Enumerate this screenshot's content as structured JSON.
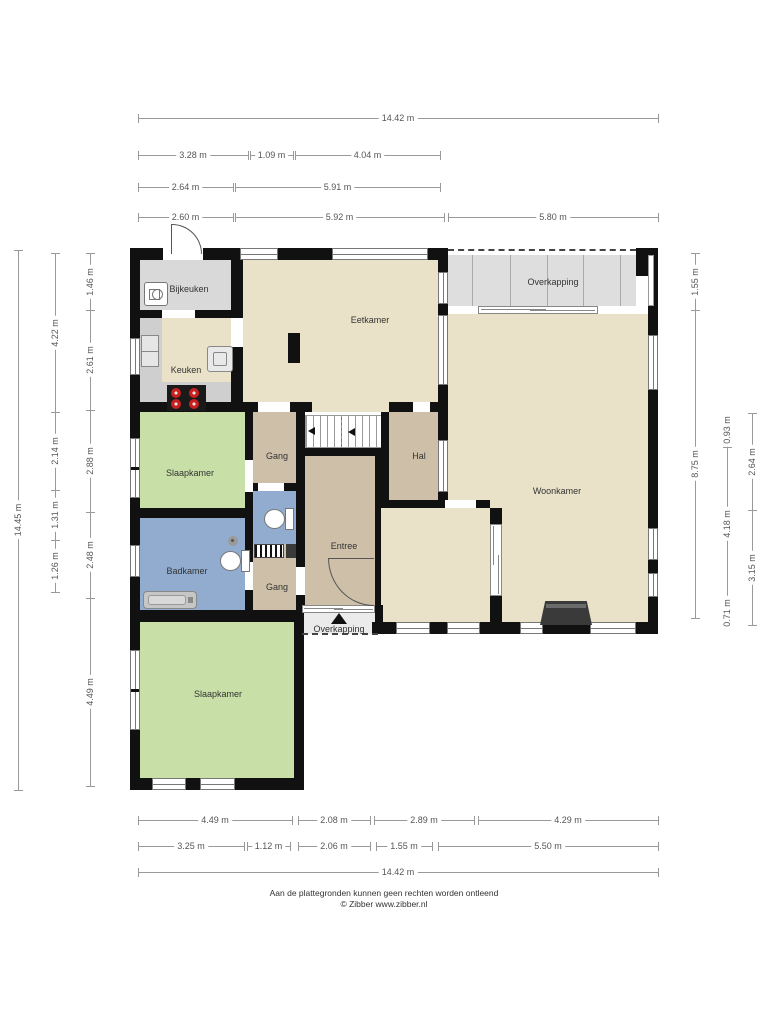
{
  "footer": {
    "line1": "Aan de plattegronden kunnen geen rechten worden ontleend",
    "line2": "© Zibber www.zibber.nl"
  },
  "colors": {
    "cream": "#e9e2c8",
    "tan": "#cdbfa8",
    "green": "#c8e0a8",
    "blue": "#91acce",
    "grayroom": "#d9d9d9",
    "overkap": "#dedede",
    "overkap2": "#ebebeb",
    "wall": "#111111",
    "stove_burner": "#c72020"
  },
  "rooms": [
    {
      "name": "bijkeuken",
      "label": "Bijkeuken",
      "x": 140,
      "y": 260,
      "w": 91,
      "h": 50,
      "fill": "grayroom",
      "lx": 189,
      "ly": 289
    },
    {
      "name": "keuken",
      "label": "Keuken",
      "x": 140,
      "y": 318,
      "w": 103,
      "h": 94,
      "fill": "cream",
      "lx": 186,
      "ly": 370
    },
    {
      "name": "eetkamer",
      "label": "Eetkamer",
      "x": 243,
      "y": 260,
      "w": 195,
      "h": 152,
      "fill": "cream",
      "lx": 370,
      "ly": 320
    },
    {
      "name": "overkapping-boven",
      "label": "Overkapping",
      "x": 448,
      "y": 255,
      "w": 188,
      "h": 51,
      "fill": "overkap",
      "lx": 553,
      "ly": 282
    },
    {
      "name": "woonkamer",
      "label": "Woonkamer",
      "x": 448,
      "y": 314,
      "w": 200,
      "h": 310,
      "fill": "cream",
      "lx": 557,
      "ly": 491
    },
    {
      "name": "woonkamer-nis",
      "label": "",
      "x": 381,
      "y": 508,
      "w": 109,
      "h": 116,
      "fill": "cream",
      "lx": 0,
      "ly": 0
    },
    {
      "name": "hal",
      "label": "Hal",
      "x": 381,
      "y": 412,
      "w": 57,
      "h": 88,
      "fill": "tan",
      "lx": 419,
      "ly": 456
    },
    {
      "name": "gang-boven",
      "label": "Gang",
      "x": 253,
      "y": 412,
      "w": 43,
      "h": 71,
      "fill": "tan",
      "lx": 277,
      "ly": 456
    },
    {
      "name": "entree",
      "label": "Entree",
      "x": 305,
      "y": 456,
      "w": 70,
      "h": 151,
      "fill": "tan",
      "lx": 344,
      "ly": 546
    },
    {
      "name": "toilet",
      "label": "",
      "x": 253,
      "y": 491,
      "w": 43,
      "h": 53,
      "fill": "blue",
      "lx": 0,
      "ly": 0
    },
    {
      "name": "gang-onder",
      "label": "Gang",
      "x": 253,
      "y": 544,
      "w": 43,
      "h": 66,
      "fill": "tan",
      "lx": 277,
      "ly": 587
    },
    {
      "name": "badkamer",
      "label": "Badkamer",
      "x": 140,
      "y": 518,
      "w": 105,
      "h": 92,
      "fill": "blue",
      "lx": 187,
      "ly": 571
    },
    {
      "name": "slaapkamer-1",
      "label": "Slaapkamer",
      "x": 140,
      "y": 412,
      "w": 105,
      "h": 96,
      "fill": "green",
      "lx": 190,
      "ly": 473
    },
    {
      "name": "slaapkamer-2",
      "label": "Slaapkamer",
      "x": 140,
      "y": 622,
      "w": 154,
      "h": 156,
      "fill": "green",
      "lx": 218,
      "ly": 694
    },
    {
      "name": "overkapping-onder",
      "label": "Overkapping",
      "x": 302,
      "y": 610,
      "w": 73,
      "h": 24,
      "fill": "overkap2",
      "lx": 339,
      "ly": 629
    }
  ],
  "walls": [
    {
      "x": 130,
      "y": 248,
      "w": 318,
      "h": 12
    },
    {
      "x": 636,
      "y": 248,
      "w": 22,
      "h": 28
    },
    {
      "x": 648,
      "y": 276,
      "w": 10,
      "h": 358
    },
    {
      "x": 372,
      "y": 622,
      "w": 286,
      "h": 12
    },
    {
      "x": 130,
      "y": 248,
      "w": 10,
      "h": 542
    },
    {
      "x": 130,
      "y": 778,
      "w": 174,
      "h": 12
    },
    {
      "x": 294,
      "y": 610,
      "w": 10,
      "h": 180
    },
    {
      "x": 130,
      "y": 610,
      "w": 174,
      "h": 12
    },
    {
      "x": 231,
      "y": 248,
      "w": 12,
      "h": 70
    },
    {
      "x": 140,
      "y": 310,
      "w": 91,
      "h": 8
    },
    {
      "x": 231,
      "y": 347,
      "w": 12,
      "h": 65
    },
    {
      "x": 438,
      "y": 255,
      "w": 10,
      "h": 157
    },
    {
      "x": 130,
      "y": 402,
      "w": 123,
      "h": 10
    },
    {
      "x": 243,
      "y": 402,
      "w": 15,
      "h": 10
    },
    {
      "x": 290,
      "y": 402,
      "w": 22,
      "h": 10
    },
    {
      "x": 389,
      "y": 402,
      "w": 59,
      "h": 10
    },
    {
      "x": 245,
      "y": 412,
      "w": 8,
      "h": 98
    },
    {
      "x": 130,
      "y": 508,
      "w": 123,
      "h": 10
    },
    {
      "x": 245,
      "y": 518,
      "w": 8,
      "h": 92
    },
    {
      "x": 296,
      "y": 412,
      "w": 9,
      "h": 200
    },
    {
      "x": 245,
      "y": 483,
      "w": 60,
      "h": 8
    },
    {
      "x": 305,
      "y": 448,
      "w": 84,
      "h": 8
    },
    {
      "x": 375,
      "y": 448,
      "w": 6,
      "h": 176
    },
    {
      "x": 381,
      "y": 412,
      "w": 8,
      "h": 88
    },
    {
      "x": 438,
      "y": 412,
      "w": 10,
      "h": 88
    },
    {
      "x": 381,
      "y": 500,
      "w": 109,
      "h": 8
    },
    {
      "x": 490,
      "y": 508,
      "w": 12,
      "h": 16
    },
    {
      "x": 490,
      "y": 596,
      "w": 12,
      "h": 28
    },
    {
      "x": 375,
      "y": 605,
      "w": 8,
      "h": 29
    }
  ],
  "gaps": [
    {
      "x": 163,
      "y": 248,
      "w": 40,
      "h": 12
    },
    {
      "x": 162,
      "y": 310,
      "w": 33,
      "h": 8
    },
    {
      "x": 258,
      "y": 402,
      "w": 32,
      "h": 10
    },
    {
      "x": 413,
      "y": 402,
      "w": 17,
      "h": 10
    },
    {
      "x": 245,
      "y": 460,
      "w": 8,
      "h": 32
    },
    {
      "x": 245,
      "y": 562,
      "w": 8,
      "h": 28
    },
    {
      "x": 258,
      "y": 483,
      "w": 26,
      "h": 8
    },
    {
      "x": 296,
      "y": 567,
      "w": 9,
      "h": 28
    },
    {
      "x": 445,
      "y": 500,
      "w": 31,
      "h": 8
    },
    {
      "x": 231,
      "y": 318,
      "w": 12,
      "h": 29
    }
  ],
  "windows": [
    {
      "x": 240,
      "y": 248,
      "w": 38,
      "h": 12,
      "o": "h"
    },
    {
      "x": 332,
      "y": 248,
      "w": 96,
      "h": 12,
      "o": "h"
    },
    {
      "x": 130,
      "y": 338,
      "w": 10,
      "h": 37,
      "o": "v"
    },
    {
      "x": 130,
      "y": 438,
      "w": 10,
      "h": 60,
      "o": "v",
      "divs": [
        28
      ]
    },
    {
      "x": 130,
      "y": 545,
      "w": 10,
      "h": 32,
      "o": "v"
    },
    {
      "x": 130,
      "y": 650,
      "w": 10,
      "h": 80,
      "o": "v",
      "divs": [
        38
      ]
    },
    {
      "x": 152,
      "y": 778,
      "w": 34,
      "h": 12,
      "o": "h"
    },
    {
      "x": 200,
      "y": 778,
      "w": 35,
      "h": 12,
      "o": "h"
    },
    {
      "x": 648,
      "y": 335,
      "w": 10,
      "h": 55,
      "o": "v"
    },
    {
      "x": 648,
      "y": 528,
      "w": 10,
      "h": 32,
      "o": "v"
    },
    {
      "x": 648,
      "y": 573,
      "w": 10,
      "h": 24,
      "o": "v"
    },
    {
      "x": 396,
      "y": 622,
      "w": 34,
      "h": 12,
      "o": "h"
    },
    {
      "x": 447,
      "y": 622,
      "w": 33,
      "h": 12,
      "o": "h"
    },
    {
      "x": 520,
      "y": 622,
      "w": 23,
      "h": 12,
      "o": "h"
    },
    {
      "x": 590,
      "y": 622,
      "w": 46,
      "h": 12,
      "o": "h"
    },
    {
      "x": 438,
      "y": 272,
      "w": 10,
      "h": 32,
      "o": "v"
    },
    {
      "x": 438,
      "y": 315,
      "w": 10,
      "h": 70,
      "o": "v"
    },
    {
      "x": 438,
      "y": 440,
      "w": 10,
      "h": 52,
      "o": "v"
    }
  ],
  "sliders": [
    {
      "name": "overkapping-schuifpui",
      "x": 478,
      "y": 306,
      "w": 120,
      "h": 8,
      "o": "h"
    },
    {
      "name": "entree-pui",
      "x": 302,
      "y": 605,
      "w": 73,
      "h": 8,
      "o": "h"
    },
    {
      "name": "nis-schuifdeur",
      "x": 490,
      "y": 524,
      "w": 12,
      "h": 72,
      "o": "v"
    }
  ],
  "dashes": [
    {
      "x": 448,
      "y": 249,
      "w": 188
    },
    {
      "x": 302,
      "y": 633,
      "w": 76
    }
  ],
  "overkap_lines": {
    "xs": [
      472,
      510,
      547,
      583,
      620
    ],
    "y": 255,
    "h": 51
  },
  "edges": [
    {
      "x": 648,
      "y": 255,
      "w": 6,
      "h": 51
    }
  ],
  "fixtures": [
    {
      "type": "counter",
      "x": 140,
      "y": 318,
      "w": 22,
      "h": 94
    },
    {
      "type": "counter",
      "x": 140,
      "y": 382,
      "w": 91,
      "h": 30
    },
    {
      "type": "stove",
      "x": 167,
      "y": 385,
      "w": 39,
      "h": 26
    },
    {
      "type": "washer",
      "x": 144,
      "y": 282,
      "w": 24,
      "h": 24
    },
    {
      "type": "fridge",
      "x": 141,
      "y": 335,
      "w": 18,
      "h": 32
    },
    {
      "type": "sinkunit",
      "x": 207,
      "y": 346,
      "w": 26,
      "h": 26
    },
    {
      "type": "blackbox",
      "x": 288,
      "y": 333,
      "w": 12,
      "h": 30
    },
    {
      "type": "stairs",
      "x": 305,
      "y": 415,
      "w": 84,
      "h": 33
    },
    {
      "type": "toilet",
      "x": 218,
      "y": 548,
      "w": 32,
      "h": 26
    },
    {
      "type": "toilet",
      "x": 262,
      "y": 506,
      "w": 32,
      "h": 26
    },
    {
      "type": "tub",
      "x": 143,
      "y": 591,
      "w": 54,
      "h": 18
    },
    {
      "type": "shower",
      "x": 228,
      "y": 536,
      "w": 10,
      "h": 10
    },
    {
      "type": "meter",
      "x": 254,
      "y": 544,
      "w": 30,
      "h": 14
    },
    {
      "type": "metersq",
      "x": 286,
      "y": 544,
      "w": 10,
      "h": 14
    },
    {
      "type": "fireplace",
      "x": 540,
      "y": 601,
      "w": 52,
      "h": 24
    },
    {
      "type": "arcTL",
      "x": 172,
      "y": 224,
      "w": 30,
      "h": 30
    },
    {
      "type": "leaf",
      "x": 171,
      "y": 224,
      "w": 1,
      "h": 30
    },
    {
      "type": "arcBL",
      "x": 328,
      "y": 558,
      "w": 46,
      "h": 48
    },
    {
      "type": "leaf",
      "x": 328,
      "y": 558,
      "w": 46,
      "h": 1
    },
    {
      "type": "tri-up",
      "x": 331,
      "y": 613,
      "w": 16,
      "h": 11
    },
    {
      "type": "tri-left",
      "x": 308,
      "y": 427,
      "w": 7,
      "h": 8
    },
    {
      "type": "tri-left",
      "x": 348,
      "y": 428,
      "w": 7,
      "h": 8
    },
    {
      "type": "stairdash",
      "x": 341,
      "y": 417,
      "w": 1,
      "h": 30
    }
  ],
  "dims_h": [
    {
      "y": 118,
      "x1": 138,
      "x2": 658,
      "label": "14.42 m"
    },
    {
      "y": 155,
      "x1": 138,
      "x2": 248,
      "label": "3.28 m"
    },
    {
      "y": 155,
      "x1": 250,
      "x2": 293,
      "label": "1.09 m"
    },
    {
      "y": 155,
      "x1": 295,
      "x2": 440,
      "label": "4.04 m"
    },
    {
      "y": 187,
      "x1": 138,
      "x2": 233,
      "label": "2.64 m"
    },
    {
      "y": 187,
      "x1": 235,
      "x2": 440,
      "label": "5.91 m"
    },
    {
      "y": 217,
      "x1": 138,
      "x2": 233,
      "label": "2.60 m"
    },
    {
      "y": 217,
      "x1": 235,
      "x2": 444,
      "label": "5.92 m"
    },
    {
      "y": 217,
      "x1": 448,
      "x2": 658,
      "label": "5.80 m"
    },
    {
      "y": 820,
      "x1": 138,
      "x2": 292,
      "label": "4.49 m"
    },
    {
      "y": 820,
      "x1": 298,
      "x2": 370,
      "label": "2.08 m"
    },
    {
      "y": 820,
      "x1": 374,
      "x2": 474,
      "label": "2.89 m"
    },
    {
      "y": 820,
      "x1": 478,
      "x2": 658,
      "label": "4.29 m"
    },
    {
      "y": 846,
      "x1": 138,
      "x2": 244,
      "label": "3.25 m"
    },
    {
      "y": 846,
      "x1": 247,
      "x2": 290,
      "label": "1.12 m"
    },
    {
      "y": 846,
      "x1": 298,
      "x2": 370,
      "label": "2.06 m"
    },
    {
      "y": 846,
      "x1": 376,
      "x2": 432,
      "label": "1.55 m"
    },
    {
      "y": 846,
      "x1": 438,
      "x2": 658,
      "label": "5.50 m"
    },
    {
      "y": 872,
      "x1": 138,
      "x2": 658,
      "label": "14.42 m"
    }
  ],
  "dims_v": [
    {
      "x": 18,
      "y1": 250,
      "y2": 790,
      "label": "14.45 m"
    },
    {
      "x": 55,
      "y1": 253,
      "y2": 412,
      "label": "4.22 m"
    },
    {
      "x": 55,
      "y1": 412,
      "y2": 490,
      "label": "2.14 m"
    },
    {
      "x": 55,
      "y1": 490,
      "y2": 540,
      "label": "1.31 m"
    },
    {
      "x": 55,
      "y1": 540,
      "y2": 592,
      "label": "1.26 m"
    },
    {
      "x": 90,
      "y1": 253,
      "y2": 310,
      "label": "1.46 m"
    },
    {
      "x": 90,
      "y1": 310,
      "y2": 410,
      "label": "2.61 m"
    },
    {
      "x": 90,
      "y1": 410,
      "y2": 512,
      "label": "2.88 m"
    },
    {
      "x": 90,
      "y1": 512,
      "y2": 598,
      "label": "2.48 m"
    },
    {
      "x": 90,
      "y1": 598,
      "y2": 786,
      "label": "4.49 m"
    },
    {
      "x": 695,
      "y1": 253,
      "y2": 310,
      "label": "1.55 m"
    },
    {
      "x": 695,
      "y1": 310,
      "y2": 618,
      "label": "8.75 m"
    },
    {
      "x": 727,
      "y1": 413,
      "y2": 447,
      "label": "0.93 m"
    },
    {
      "x": 727,
      "y1": 447,
      "y2": 600,
      "label": "4.18 m"
    },
    {
      "x": 727,
      "y1": 600,
      "y2": 626,
      "label": "0.71 m"
    },
    {
      "x": 752,
      "y1": 413,
      "y2": 510,
      "label": "2.64 m"
    },
    {
      "x": 752,
      "y1": 510,
      "y2": 625,
      "label": "3.15 m"
    }
  ]
}
